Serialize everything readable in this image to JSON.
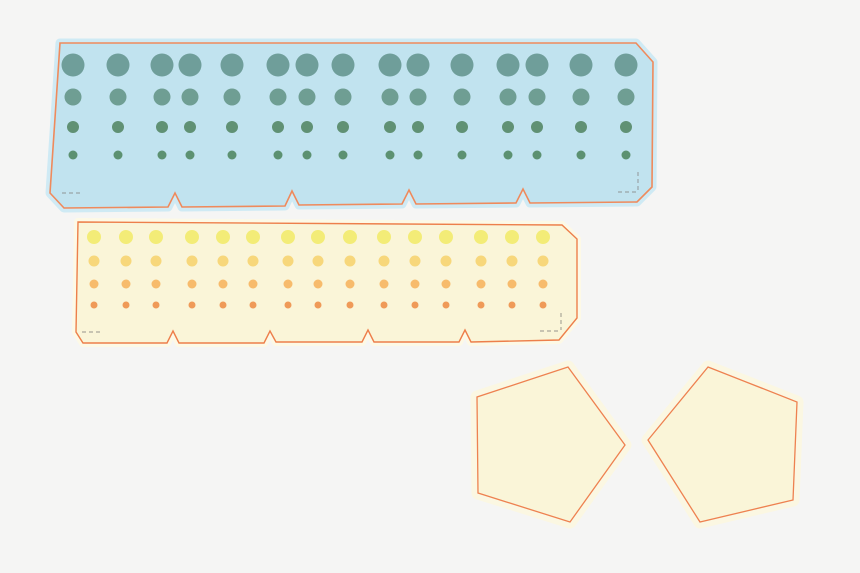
{
  "canvas": {
    "width": 860,
    "height": 573,
    "background": "#f5f5f4"
  },
  "shapes": {
    "strips": [
      {
        "id": "blue-strip",
        "fill": "#c1e3ef",
        "halo": "#cfeaf4",
        "halo_width": 9,
        "stroke": "#ef8a5c",
        "stroke_width": 1.6,
        "dash_color": "#9aa4a8",
        "outline": [
          [
            60,
            43
          ],
          [
            636,
            43
          ],
          [
            653,
            62
          ],
          [
            652,
            187
          ],
          [
            637,
            202
          ],
          [
            530,
            203
          ],
          [
            523,
            189
          ],
          [
            516,
            203
          ],
          [
            416,
            204
          ],
          [
            409,
            190
          ],
          [
            402,
            204
          ],
          [
            299,
            205
          ],
          [
            292,
            191
          ],
          [
            285,
            206
          ],
          [
            182,
            207
          ],
          [
            175,
            193
          ],
          [
            168,
            207
          ],
          [
            64,
            208
          ],
          [
            50,
            193
          ]
        ],
        "fold_dashes": [
          [
            62,
            193,
            82,
            193
          ],
          [
            638,
            172,
            638,
            191
          ],
          [
            618,
            192,
            637,
            192
          ]
        ],
        "dot_columns": [
          73,
          118,
          162,
          190,
          232,
          278,
          307,
          343,
          390,
          418,
          462,
          508,
          537,
          581,
          626
        ],
        "dot_rows": [
          {
            "y": 65,
            "r": 11.5,
            "color": "#6f9e9a"
          },
          {
            "y": 97,
            "r": 8.5,
            "color": "#6f9e93"
          },
          {
            "y": 127,
            "r": 6,
            "color": "#609174"
          },
          {
            "y": 155,
            "r": 4.5,
            "color": "#5c9171"
          }
        ]
      },
      {
        "id": "yellow-strip",
        "fill": "#faf5d8",
        "halo": "#fdf9e6",
        "halo_width": 8,
        "stroke": "#ed7f4b",
        "stroke_width": 1.4,
        "dash_color": "#aaa89a",
        "outline": [
          [
            78,
            222
          ],
          [
            562,
            225
          ],
          [
            577,
            239
          ],
          [
            577,
            318
          ],
          [
            559,
            340
          ],
          [
            471,
            342
          ],
          [
            465,
            330
          ],
          [
            459,
            342
          ],
          [
            374,
            342
          ],
          [
            368,
            330
          ],
          [
            362,
            342
          ],
          [
            276,
            342
          ],
          [
            270,
            331
          ],
          [
            264,
            343
          ],
          [
            179,
            343
          ],
          [
            173,
            331
          ],
          [
            167,
            343
          ],
          [
            83,
            343
          ],
          [
            76,
            332
          ]
        ],
        "fold_dashes": [
          [
            82,
            332,
            100,
            332
          ],
          [
            561,
            313,
            561,
            330
          ],
          [
            540,
            331,
            560,
            331
          ]
        ],
        "dot_columns": [
          94,
          126,
          156,
          192,
          223,
          253,
          288,
          318,
          350,
          384,
          415,
          446,
          481,
          512,
          543
        ],
        "dot_rows": [
          {
            "y": 237,
            "r": 7,
            "color": "#f3ec77"
          },
          {
            "y": 261,
            "r": 5.5,
            "color": "#f7d77b"
          },
          {
            "y": 284,
            "r": 4.5,
            "color": "#f7bb6c"
          },
          {
            "y": 305,
            "r": 3.5,
            "color": "#ef9a58"
          }
        ]
      }
    ],
    "pentagons": [
      {
        "id": "pentagon-left",
        "fill": "#faf5d8",
        "halo": "#fbf7e2",
        "halo_width": 13,
        "stroke": "#ee8150",
        "stroke_width": 1.3,
        "points": [
          [
            568,
            367
          ],
          [
            625,
            445
          ],
          [
            570,
            522
          ],
          [
            478,
            493
          ],
          [
            477,
            397
          ]
        ]
      },
      {
        "id": "pentagon-right",
        "fill": "#faf5d8",
        "halo": "#fbf7e2",
        "halo_width": 13,
        "stroke": "#ee8150",
        "stroke_width": 1.3,
        "points": [
          [
            708,
            367
          ],
          [
            797,
            402
          ],
          [
            793,
            500
          ],
          [
            700,
            522
          ],
          [
            648,
            440
          ]
        ]
      }
    ]
  }
}
